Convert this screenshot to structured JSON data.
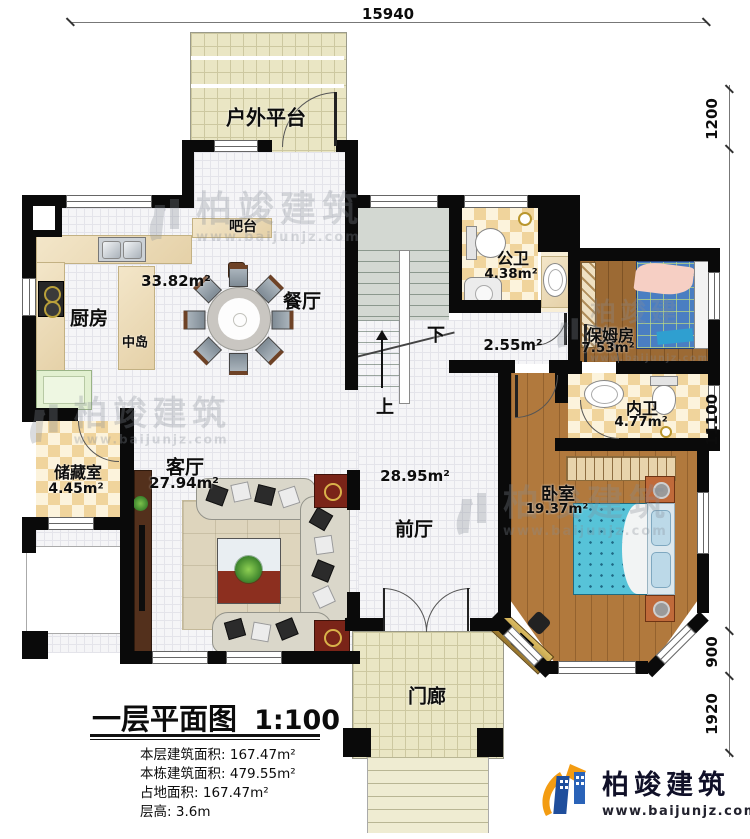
{
  "rooms": {
    "platform": {
      "name": "户外平台"
    },
    "bar": {
      "name": "吧台"
    },
    "kitchen": {
      "name": "厨房"
    },
    "island": {
      "name": "中岛"
    },
    "dining": {
      "name": "餐厅",
      "area": "33.82m²"
    },
    "public_bath": {
      "name": "公卫",
      "area": "4.38m²"
    },
    "nanny_room": {
      "name": "保姆房",
      "area": "7.53m²"
    },
    "inner_bath": {
      "name": "内卫",
      "area": "4.77m²"
    },
    "stair_hall": {
      "area": "2.55m²",
      "down": "下",
      "up": "上"
    },
    "storage": {
      "name": "储藏室",
      "area": "4.45m²"
    },
    "living": {
      "name": "客厅",
      "area": "27.94m²"
    },
    "foyer": {
      "name": "前厅",
      "area": "28.95m²"
    },
    "bedroom": {
      "name": "卧室",
      "area": "19.37m²"
    },
    "porch": {
      "name": "门廊"
    }
  },
  "dimensions": {
    "top": "15940",
    "right": [
      "1200",
      "11100",
      "900",
      "1920"
    ]
  },
  "legend": {
    "title": "一层平面图",
    "scale": "1:100",
    "stats": [
      {
        "label": "本层建筑面积:",
        "value": "167.47m²"
      },
      {
        "label": "本栋建筑面积:",
        "value": "479.55m²"
      },
      {
        "label": "占地面积:",
        "value": "167.47m²"
      },
      {
        "label": "层高:",
        "value": "3.6m"
      }
    ]
  },
  "branding": {
    "company": "柏竣建筑",
    "website": "www.baijunjz.com"
  },
  "watermark": {
    "text": "柏竣建筑",
    "url": "www.baijunjz.com"
  }
}
